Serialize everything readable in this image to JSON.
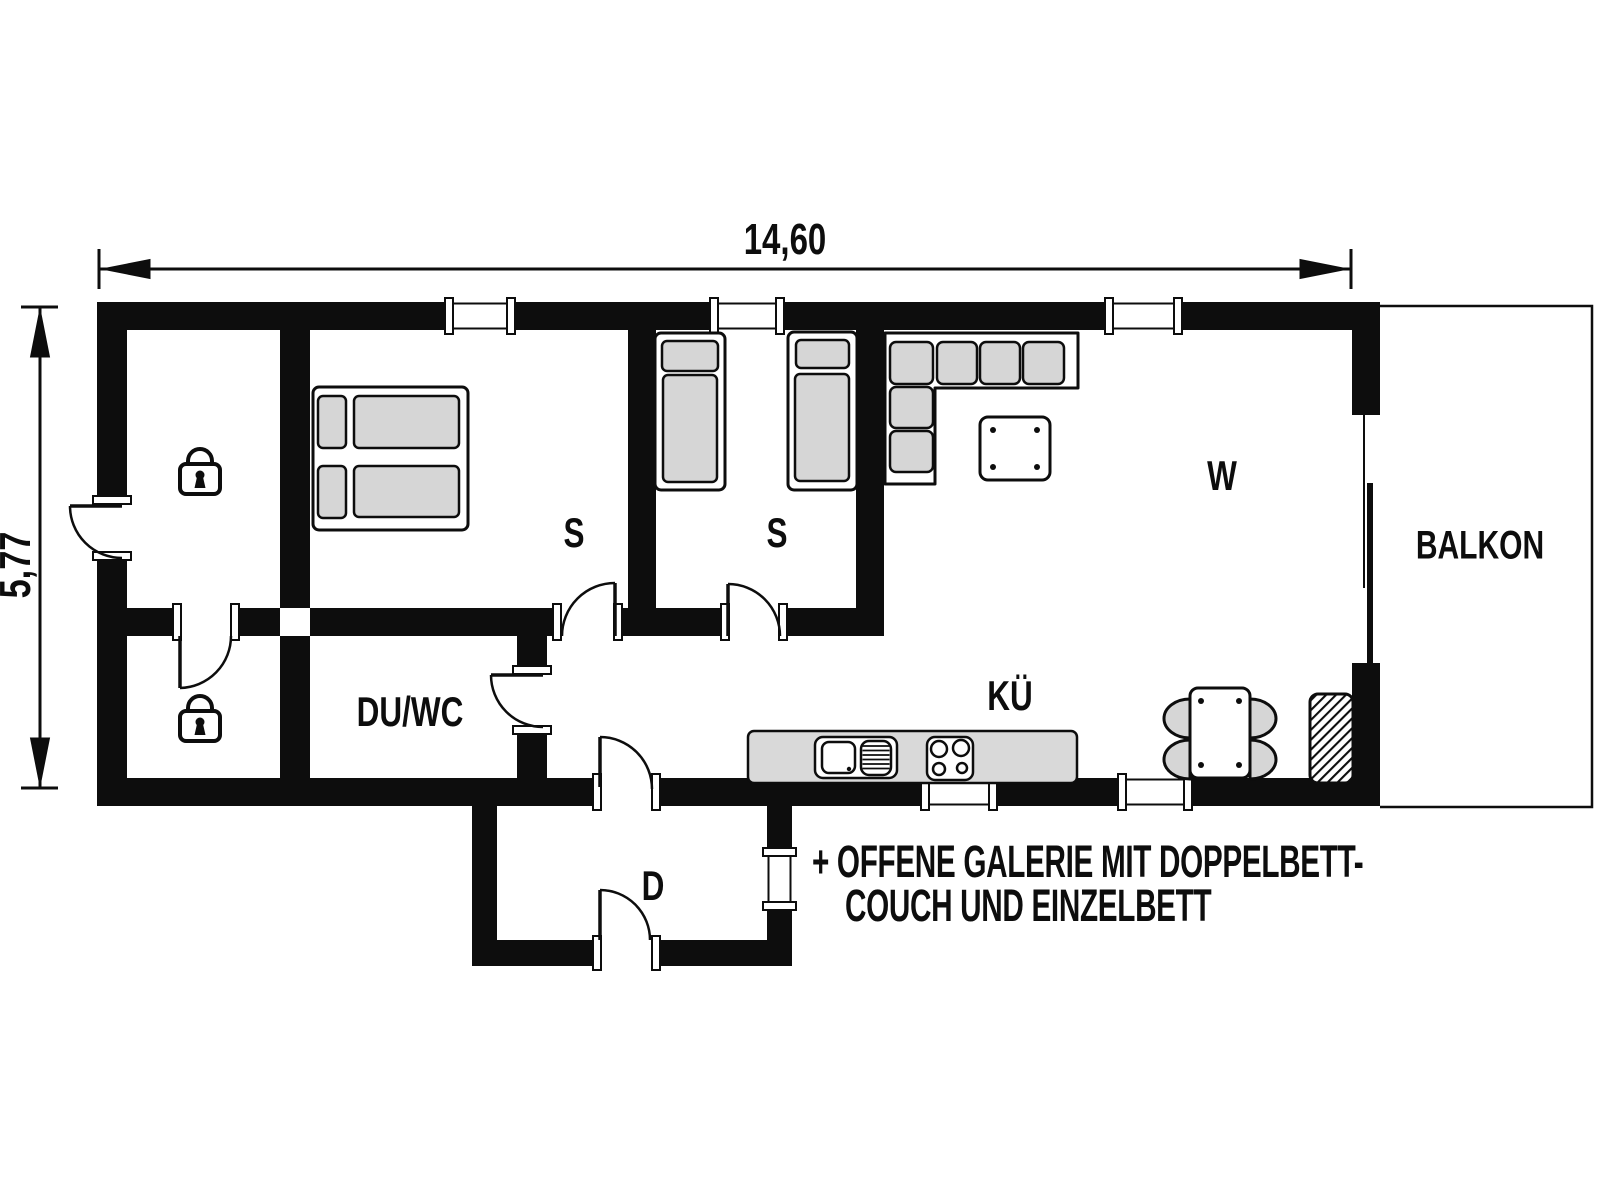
{
  "plan": {
    "type": "floor-plan",
    "dimensions": {
      "width_label": "14,60",
      "height_label": "5,77"
    },
    "rooms": {
      "bedroom1": "S",
      "bedroom2": "S",
      "living": "W",
      "kitchen": "KÜ",
      "bath": "DU/WC",
      "hall": "D",
      "balcony": "BALKON"
    },
    "locked_rooms_count": 2,
    "note": {
      "line1": "+ OFFENE GALERIE MIT DOPPELBETT-",
      "line2": "COUCH UND EINZELBETT"
    },
    "colors": {
      "wall": "#0d0d0d",
      "furniture_fill": "#d6d6d6",
      "counter_fill": "#d9d9d9",
      "background": "#ffffff"
    }
  }
}
